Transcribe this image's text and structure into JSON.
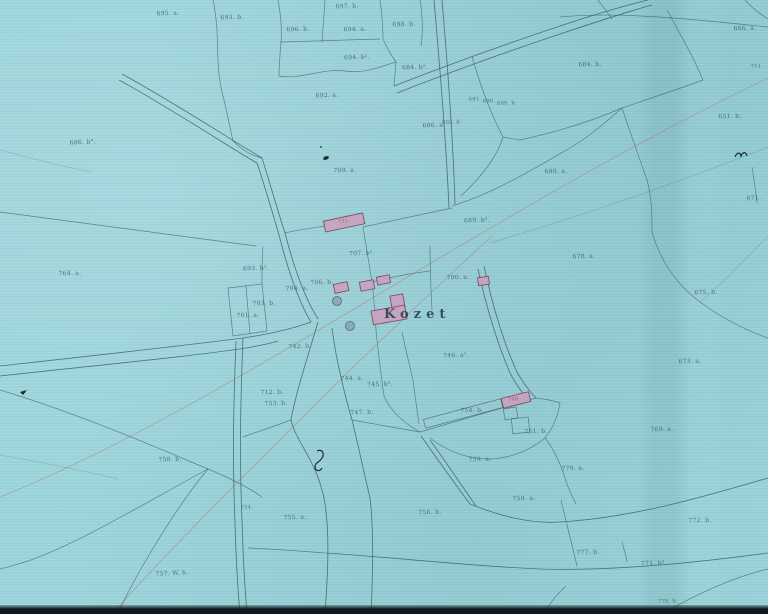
{
  "village": {
    "name": "Kozet"
  },
  "colors": {
    "paper": "#9dd6dc",
    "ink": "#3d5b68",
    "bfill": "#c9a3bf",
    "bstroke": "#7d4560",
    "red": "#b25f5f",
    "labelink": "#31505e",
    "edge": "#10181b"
  },
  "parcel_labels": [
    {
      "text": "695. a.",
      "x": 168,
      "y": 14
    },
    {
      "text": "693. b.",
      "x": 232,
      "y": 18
    },
    {
      "text": "697. b.",
      "x": 347,
      "y": 7
    },
    {
      "text": "696. b.",
      "x": 298,
      "y": 30
    },
    {
      "text": "694. a.",
      "x": 355,
      "y": 30
    },
    {
      "text": "698. b.",
      "x": 404,
      "y": 25
    },
    {
      "text": "694. b².",
      "x": 357,
      "y": 58
    },
    {
      "text": "684. b².",
      "x": 415,
      "y": 68
    },
    {
      "text": "692. a.",
      "x": 327,
      "y": 96
    },
    {
      "text": "686. a.",
      "x": 434,
      "y": 126
    },
    {
      "text": "686. b°.",
      "x": 83,
      "y": 143
    },
    {
      "text": "684. b.",
      "x": 590,
      "y": 65
    },
    {
      "text": "666. a.",
      "x": 745,
      "y": 29
    },
    {
      "text": "711.",
      "x": 757,
      "y": 67,
      "s": 5
    },
    {
      "text": "651. b.",
      "x": 730,
      "y": 117
    },
    {
      "text": "671.",
      "x": 754,
      "y": 199
    },
    {
      "text": "680. a.",
      "x": 556,
      "y": 172
    },
    {
      "text": "678. a.",
      "x": 584,
      "y": 257
    },
    {
      "text": "675. b.",
      "x": 706,
      "y": 293
    },
    {
      "text": "673. a.",
      "x": 690,
      "y": 362
    },
    {
      "text": "764. a.",
      "x": 70,
      "y": 274
    },
    {
      "text": "693. b².",
      "x": 256,
      "y": 269
    },
    {
      "text": "703. b.",
      "x": 264,
      "y": 304
    },
    {
      "text": "701. a.",
      "x": 248,
      "y": 316
    },
    {
      "text": "704. a.",
      "x": 297,
      "y": 289
    },
    {
      "text": "706. b.",
      "x": 322,
      "y": 283
    },
    {
      "text": "707. b².",
      "x": 362,
      "y": 254
    },
    {
      "text": "708. a.",
      "x": 345,
      "y": 171
    },
    {
      "text": "691.",
      "x": 475,
      "y": 100,
      "s": 5
    },
    {
      "text": "690.",
      "x": 489,
      "y": 102,
      "s": 5
    },
    {
      "text": "689. b.",
      "x": 507,
      "y": 104,
      "s": 5
    },
    {
      "text": "692. b.",
      "x": 452,
      "y": 123,
      "s": 5
    },
    {
      "text": "689. b².",
      "x": 477,
      "y": 221
    },
    {
      "text": "700. a.",
      "x": 458,
      "y": 278
    },
    {
      "text": "731.",
      "x": 344,
      "y": 222,
      "s": 5,
      "red": true
    },
    {
      "text": "746. a².",
      "x": 456,
      "y": 356
    },
    {
      "text": "742. b.",
      "x": 300,
      "y": 347
    },
    {
      "text": "744. a.",
      "x": 352,
      "y": 379
    },
    {
      "text": "745. b².",
      "x": 380,
      "y": 385
    },
    {
      "text": "747. b.",
      "x": 362,
      "y": 413
    },
    {
      "text": "712. b.",
      "x": 272,
      "y": 393
    },
    {
      "text": "753. b.",
      "x": 276,
      "y": 404
    },
    {
      "text": "754. b.",
      "x": 472,
      "y": 411
    },
    {
      "text": "748.",
      "x": 514,
      "y": 400,
      "s": 5,
      "red": true
    },
    {
      "text": "751. b.",
      "x": 536,
      "y": 432
    },
    {
      "text": "759. a.",
      "x": 480,
      "y": 460
    },
    {
      "text": "758. a.",
      "x": 524,
      "y": 499
    },
    {
      "text": "779. a.",
      "x": 573,
      "y": 469
    },
    {
      "text": "756. b.",
      "x": 430,
      "y": 513
    },
    {
      "text": "777. b.",
      "x": 588,
      "y": 553
    },
    {
      "text": "769. a.",
      "x": 662,
      "y": 430
    },
    {
      "text": "772. b.",
      "x": 700,
      "y": 521
    },
    {
      "text": "771. b².",
      "x": 654,
      "y": 564
    },
    {
      "text": "778. b.",
      "x": 668,
      "y": 602,
      "s": 5
    },
    {
      "text": "758. h.",
      "x": 170,
      "y": 460
    },
    {
      "text": "757. W. h.",
      "x": 172,
      "y": 574,
      "r": -3
    },
    {
      "text": "754.",
      "x": 247,
      "y": 508,
      "s": 5
    },
    {
      "text": "755. a.",
      "x": 295,
      "y": 518
    }
  ]
}
